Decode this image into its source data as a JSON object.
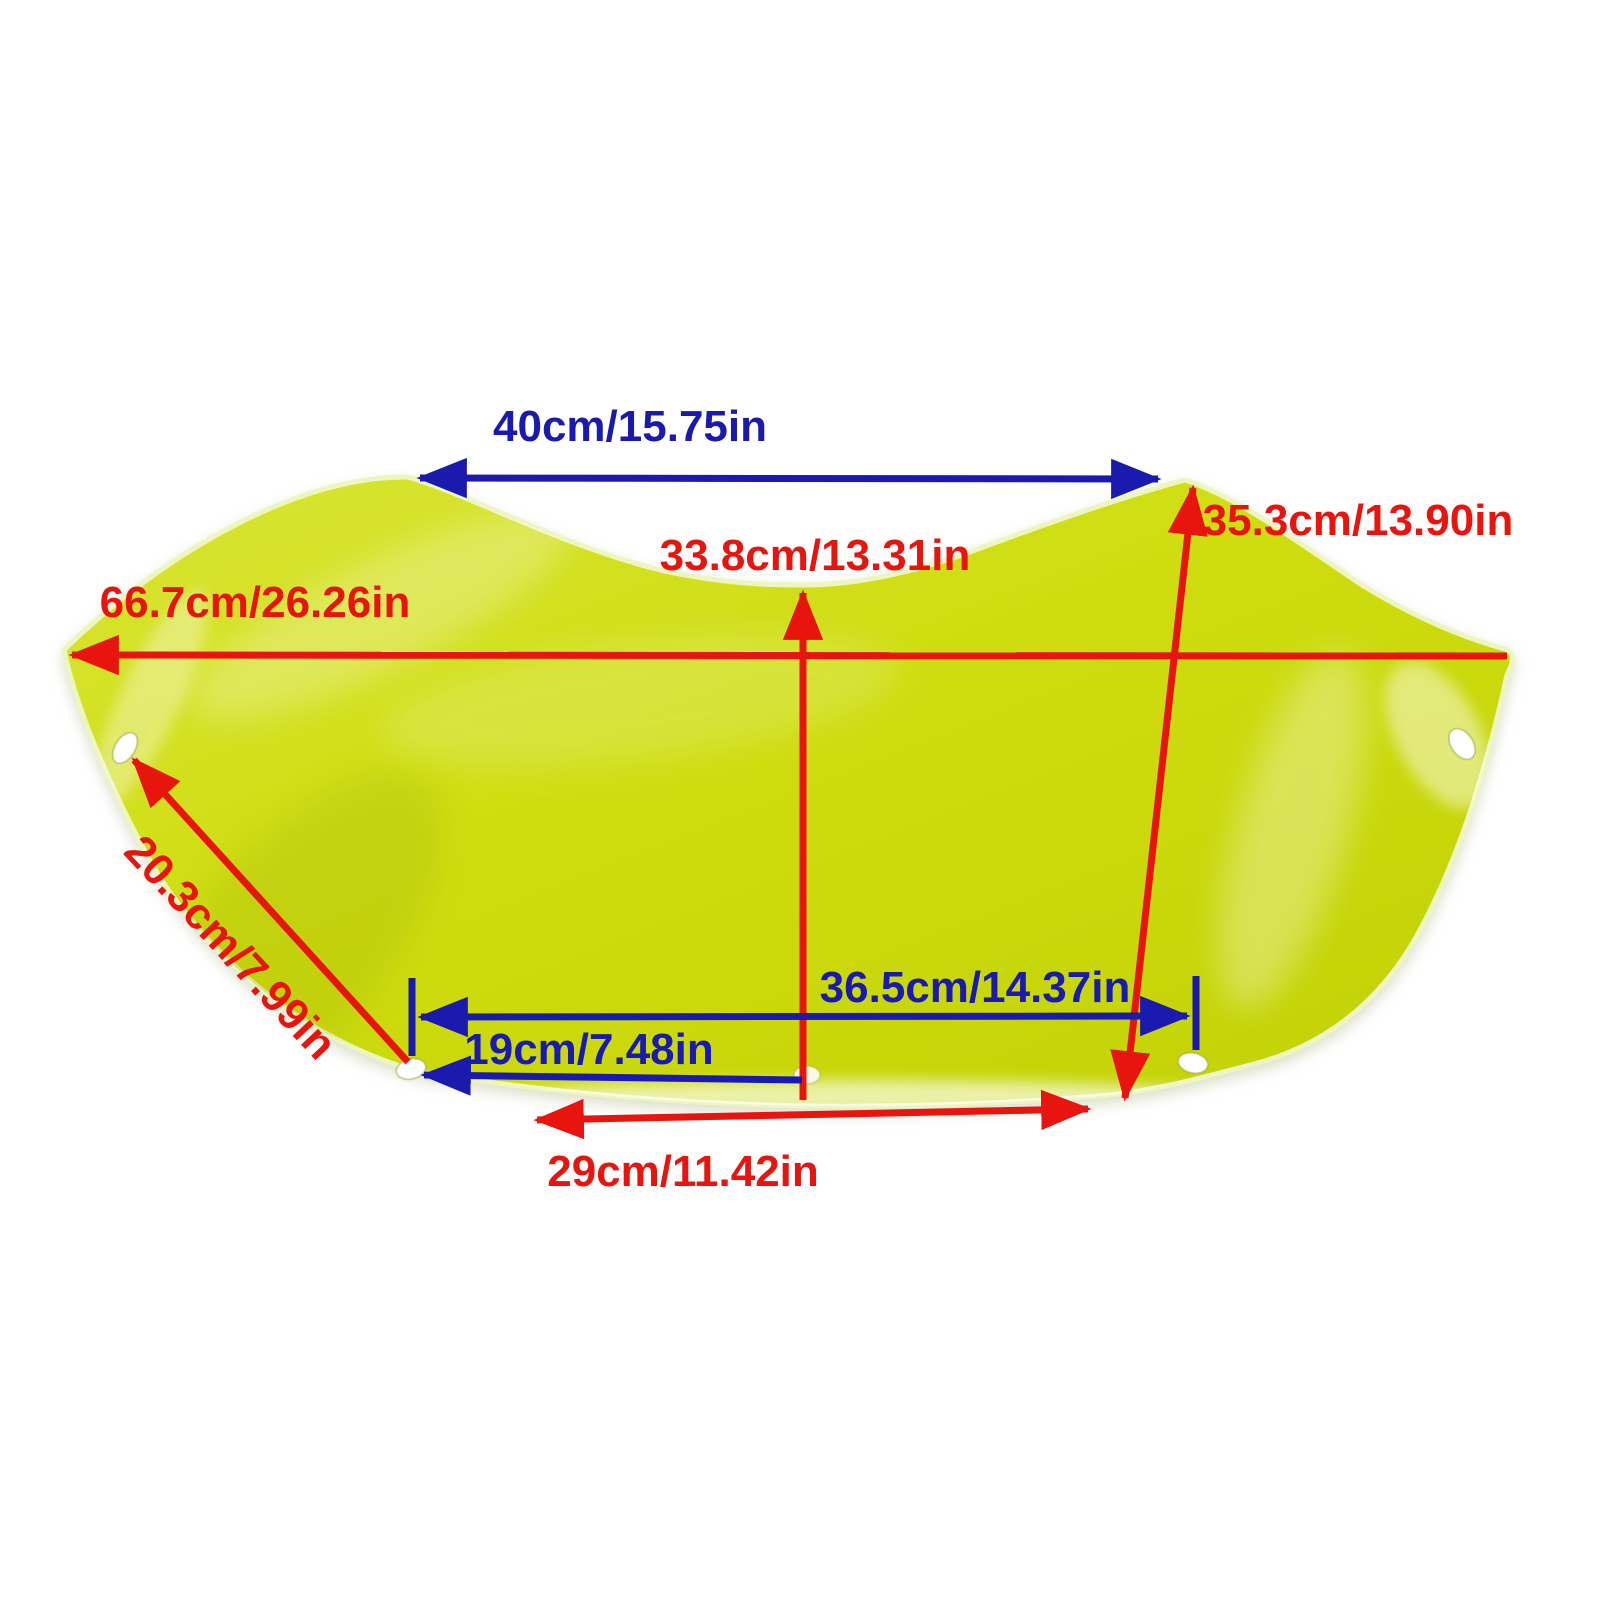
{
  "canvas": {
    "width": 1600,
    "height": 1600,
    "background": "#ffffff"
  },
  "colors": {
    "red": "#e8140e",
    "blue": "#1a1aae",
    "shape_fill_light": "#d9e535",
    "shape_fill": "#cfdd10",
    "shape_fill_dark": "#c3d206",
    "shape_edge": "#eef6c0",
    "hole_fill": "#ffffff",
    "hole_rim": "#9aa84a"
  },
  "dimensions": [
    {
      "id": "top-opening-width",
      "label": "40cm/15.75in",
      "color": "blue"
    },
    {
      "id": "center-height",
      "label": "33.8cm/13.31in",
      "color": "red"
    },
    {
      "id": "right-height",
      "label": "35.3cm/13.90in",
      "color": "red"
    },
    {
      "id": "overall-width",
      "label": "66.7cm/26.26in",
      "color": "red"
    },
    {
      "id": "left-edge-length",
      "label": "20.3cm/7.99in",
      "color": "red"
    },
    {
      "id": "mount-hole-span",
      "label": "36.5cm/14.37in",
      "color": "blue"
    },
    {
      "id": "hole-offset-width",
      "label": "19cm/7.48in",
      "color": "blue"
    },
    {
      "id": "bottom-width",
      "label": "29cm/11.42in",
      "color": "red"
    }
  ]
}
